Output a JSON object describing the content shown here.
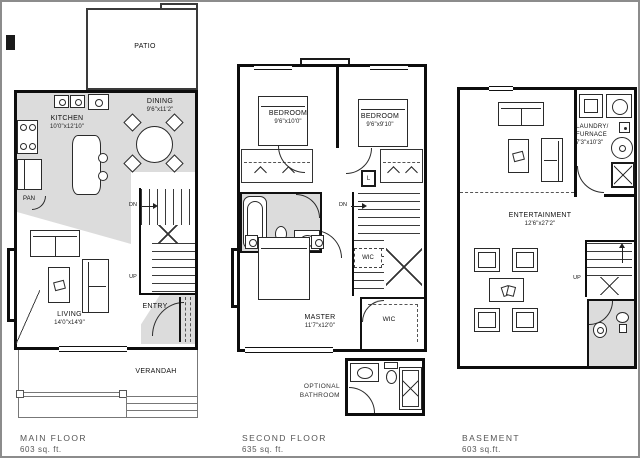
{
  "colors": {
    "shading": "#dcdcdc",
    "wall": "#0d0d0d",
    "frame": "#8c8c8c"
  },
  "floors": {
    "main": {
      "caption": "MAIN FLOOR",
      "area": "603 sq. ft.",
      "patio": "PATIO",
      "kitchen": "KITCHEN",
      "kitchen_dims": "10'0\"x12'10\"",
      "dining": "DINING",
      "dining_dims": "9'6\"x11'2\"",
      "pantry": "PAN",
      "living": "LIVING",
      "living_dims": "14'0\"x14'9\"",
      "entry": "ENTRY",
      "verandah": "VERANDAH",
      "dn": "DN",
      "up": "UP"
    },
    "second": {
      "caption": "SECOND FLOOR",
      "area": "635 sq. ft.",
      "bedroom_left": "BEDROOM",
      "bedroom_left_dims": "9'6\"x10'0\"",
      "bedroom_right": "BEDROOM",
      "bedroom_right_dims": "9'6\"x9'10\"",
      "master": "MASTER",
      "master_dims": "11'7\"x12'0\"",
      "wic_stairs": "WIC",
      "wic_room": "WIC",
      "linen": "L",
      "dn": "DN",
      "optional_line1": "OPTIONAL",
      "optional_line2": "BATHROOM"
    },
    "basement": {
      "caption": "BASEMENT",
      "area": "603 sq.ft.",
      "laundry_line1": "LAUNDRY/",
      "laundry_line2": "FURNACE",
      "laundry_dims": "7'3\"x10'3\"",
      "entertainment": "ENTERTAINMENT",
      "entertainment_dims": "12'6\"x27'2\"",
      "up": "UP"
    }
  }
}
